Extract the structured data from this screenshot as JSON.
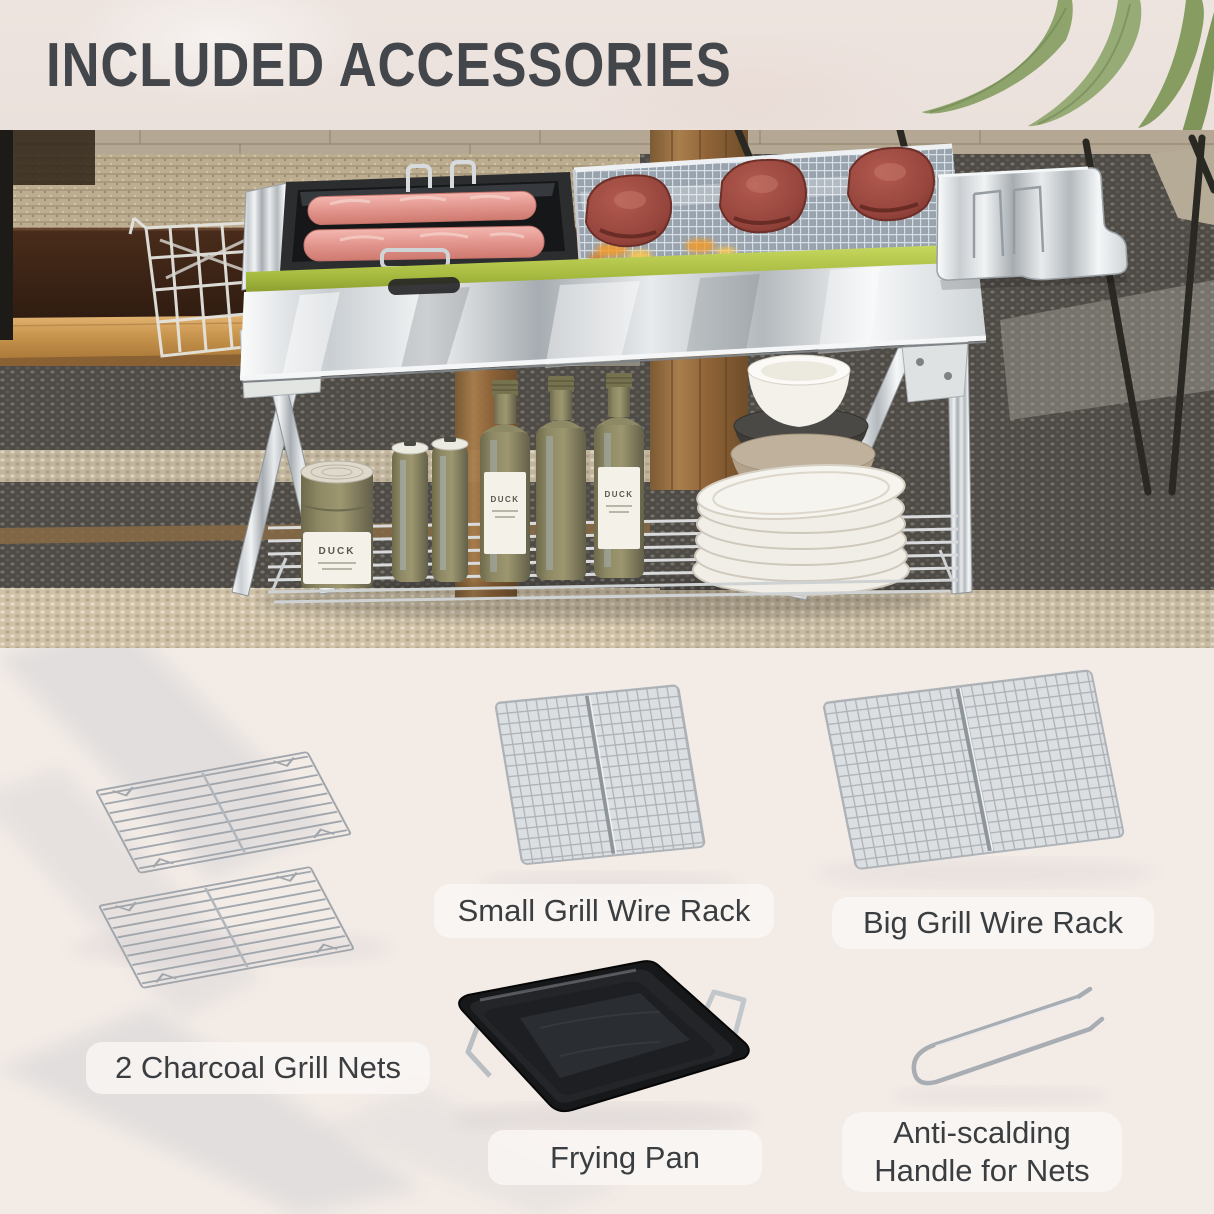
{
  "header": {
    "title": "INCLUDED ACCESSORIES"
  },
  "scene": {
    "bottle_brand": "DUCK"
  },
  "accessories": [
    {
      "id": "charcoal-grill-nets",
      "label": "2 Charcoal Grill Nets"
    },
    {
      "id": "small-grill-wire-rack",
      "label": "Small Grill Wire Rack"
    },
    {
      "id": "big-grill-wire-rack",
      "label": "Big Grill Wire Rack"
    },
    {
      "id": "frying-pan",
      "label": "Frying Pan"
    },
    {
      "id": "anti-scalding-handle",
      "label": "Anti-scalding Handle for Nets"
    }
  ],
  "colors": {
    "header_bg": "#ede4df",
    "section_bg": "#f2ebe6",
    "pill_bg": "rgba(250,247,244,0.82)",
    "text": "#3b3e41",
    "title_color": "#43464a",
    "accent_green": "#a9bd42"
  }
}
